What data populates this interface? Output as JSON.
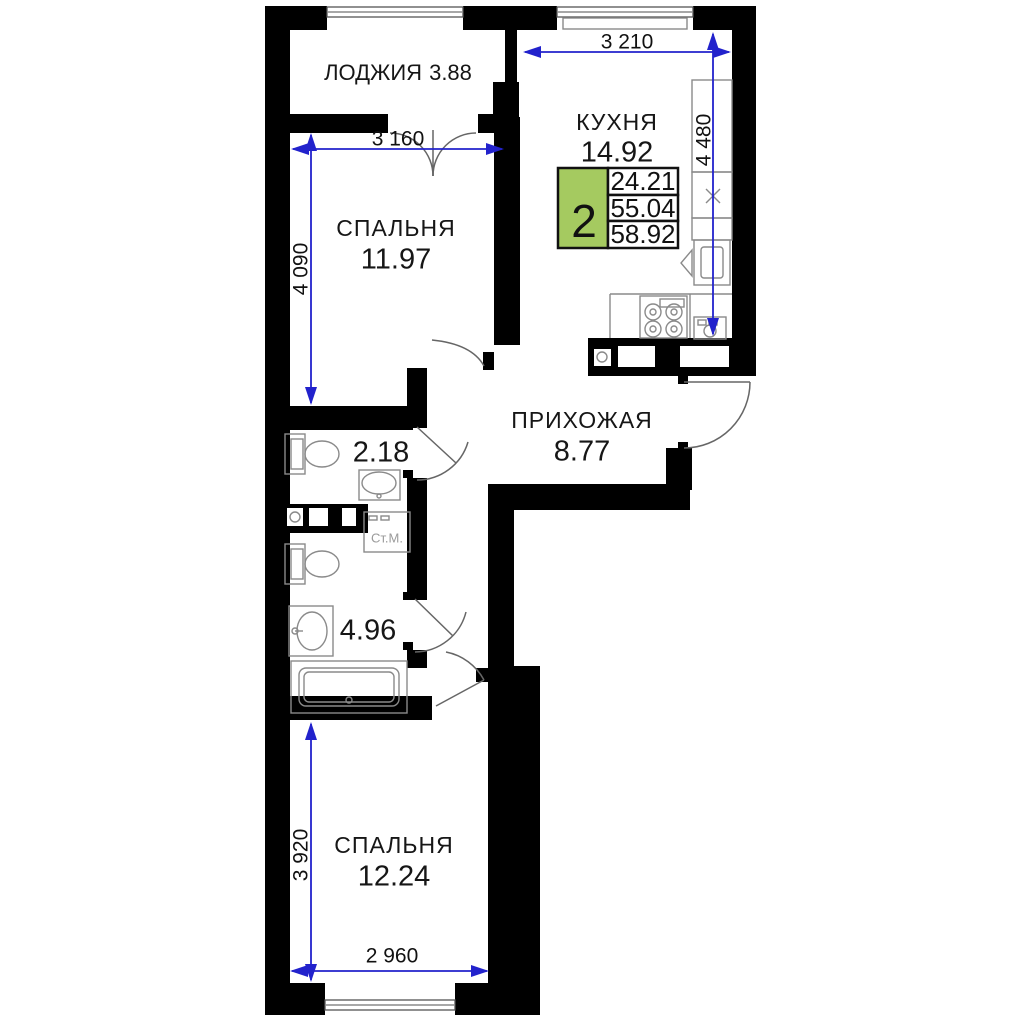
{
  "rooms": {
    "loggia": {
      "name": "ЛОДЖИЯ",
      "area": "3.88"
    },
    "kitchen": {
      "name": "КУХНЯ",
      "area": "14.92"
    },
    "bedroom1": {
      "name": "СПАЛЬНЯ",
      "area": "11.97"
    },
    "hallway": {
      "name": "ПРИХОЖАЯ",
      "area": "8.77"
    },
    "wc": {
      "area": "2.18"
    },
    "bathroom": {
      "area": "4.96"
    },
    "bedroom2": {
      "name": "СПАЛЬНЯ",
      "area": "12.24"
    }
  },
  "dimensions": {
    "kitchen_width": "3 210",
    "kitchen_height": "4 480",
    "bedroom1_width": "3 160",
    "bedroom1_height": "4 090",
    "bedroom2_height": "3 920",
    "bedroom2_width": "2 960"
  },
  "summary": {
    "room_count": "2",
    "living_area": "24.21",
    "area": "55.04",
    "total_area": "58.92"
  },
  "labels": {
    "washing_machine": "Ст.М."
  },
  "colors": {
    "wall": "#000000",
    "dimension_line": "#2222cc",
    "summary_green": "#a5ca60",
    "fixture_outline": "#8a8a8a"
  }
}
